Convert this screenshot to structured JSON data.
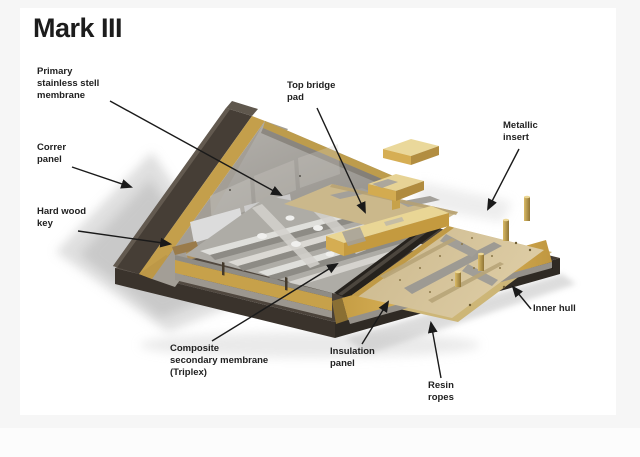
{
  "page": {
    "background_color": "#f6f6f6",
    "canvas_color": "#ffffff"
  },
  "diagram": {
    "title": "Mark III",
    "subject": "Mark III membrane containment system cutaway illustration",
    "labels": [
      {
        "id": "primary-membrane",
        "text": "Primary\nstainless stell\nmembrane"
      },
      {
        "id": "corner-panel",
        "text": "Correr\npanel"
      },
      {
        "id": "hard-wood-key",
        "text": "Hard wood\nkey"
      },
      {
        "id": "top-bridge-pad",
        "text": "Top bridge\npad"
      },
      {
        "id": "metallic-insert",
        "text": "Metallic\ninsert"
      },
      {
        "id": "inner-hull",
        "text": "Inner hull"
      },
      {
        "id": "composite-secondary-membrane",
        "text": "Composite\nsecondary membrane\n(Triplex)"
      },
      {
        "id": "insulation-panel",
        "text": "Insulation\npanel"
      },
      {
        "id": "resin-ropes",
        "text": "Resin\nropes"
      }
    ],
    "colors": {
      "plywood_gold": "#c9a44c",
      "plywood_gold_bright": "#e0bd62",
      "hull_brown": "#453d35",
      "hull_dark": "#2f2a24",
      "membrane_silver": "#b4b2ac",
      "panel_beige": "#d6c59c",
      "insert_gray": "#9d9a93",
      "label_color": "#212121",
      "leader_line_color": "#1a1a1a"
    }
  }
}
